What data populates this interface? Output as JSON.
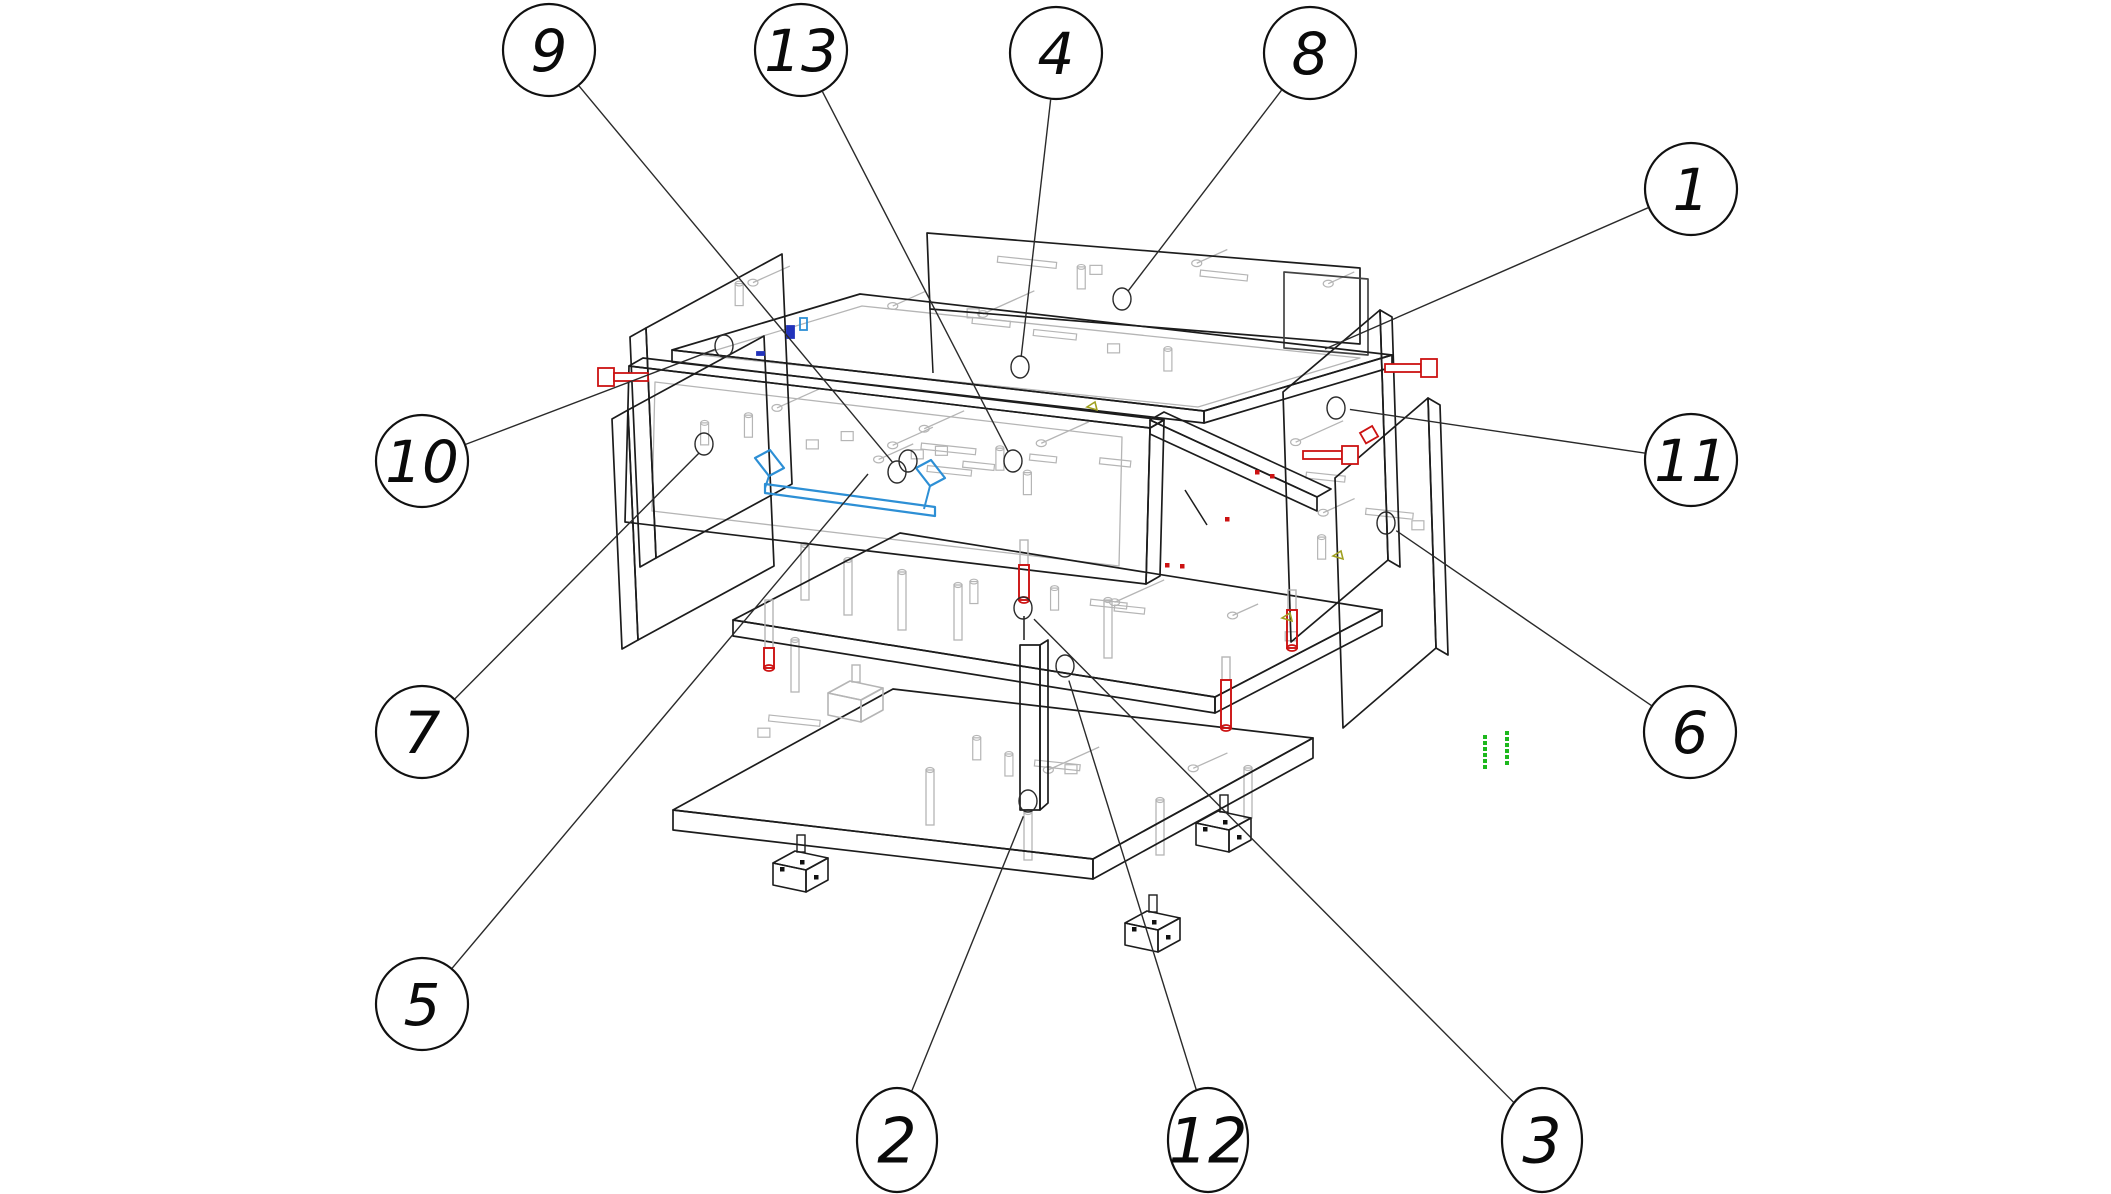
{
  "figure": {
    "title": "exploded-assembly-diagram",
    "description": "Isometric exploded wireframe drawing of a cabinet/drawer unit with numbered part callouts",
    "width": 2111,
    "height": 1194,
    "background": "#ffffff"
  },
  "colors": {
    "outline": "#1c1c1c",
    "detail": "#b5b5b5",
    "leader": "#2a2a2a",
    "red": "#cc1212",
    "blue": "#2d8fd5",
    "navy": "#2233bb",
    "green": "#1db81d",
    "olive": "#a0a020",
    "balloon_stroke": "#111111",
    "balloon_fill": "#ffffff"
  },
  "balloons": [
    {
      "label": "9",
      "x": 549,
      "y": 50,
      "shape": "circle",
      "r": 46,
      "rx": 46,
      "ry": 46,
      "target": [
        899,
        470
      ],
      "marker": true
    },
    {
      "label": "13",
      "x": 801,
      "y": 50,
      "shape": "circle",
      "r": 46,
      "rx": 46,
      "ry": 46,
      "target": [
        1013,
        461
      ],
      "marker": true
    },
    {
      "label": "4",
      "x": 1056,
      "y": 53,
      "shape": "circle",
      "r": 46,
      "rx": 46,
      "ry": 46,
      "target": [
        1020,
        367
      ],
      "marker": true
    },
    {
      "label": "8",
      "x": 1310,
      "y": 53,
      "shape": "circle",
      "r": 46,
      "rx": 46,
      "ry": 46,
      "target": [
        1122,
        299
      ],
      "marker": true
    },
    {
      "label": "1",
      "x": 1691,
      "y": 189,
      "shape": "circle",
      "r": 46,
      "rx": 46,
      "ry": 46,
      "target": [
        1325,
        349
      ],
      "marker": false
    },
    {
      "label": "10",
      "x": 422,
      "y": 461,
      "shape": "circle",
      "r": 46,
      "rx": 46,
      "ry": 46,
      "target": [
        724,
        346
      ],
      "marker": true
    },
    {
      "label": "11",
      "x": 1691,
      "y": 460,
      "shape": "circle",
      "r": 46,
      "rx": 46,
      "ry": 46,
      "target": [
        1340,
        408
      ],
      "marker": true
    },
    {
      "label": "7",
      "x": 422,
      "y": 732,
      "shape": "circle",
      "r": 46,
      "rx": 46,
      "ry": 46,
      "target": [
        706,
        446
      ],
      "marker": true
    },
    {
      "label": "6",
      "x": 1690,
      "y": 732,
      "shape": "circle",
      "r": 46,
      "rx": 46,
      "ry": 46,
      "target": [
        1388,
        525
      ],
      "marker": true
    },
    {
      "label": "5",
      "x": 422,
      "y": 1004,
      "shape": "circle",
      "r": 46,
      "rx": 46,
      "ry": 46,
      "target": [
        868,
        474
      ],
      "marker": false
    },
    {
      "label": "2",
      "x": 897,
      "y": 1140,
      "shape": "oval",
      "r": 48,
      "rx": 40,
      "ry": 52,
      "target": [
        1027,
        807
      ],
      "marker": true
    },
    {
      "label": "12",
      "x": 1208,
      "y": 1140,
      "shape": "oval",
      "r": 48,
      "rx": 40,
      "ry": 52,
      "target": [
        1066,
        671
      ],
      "marker": true
    },
    {
      "label": "3",
      "x": 1542,
      "y": 1140,
      "shape": "oval",
      "r": 48,
      "rx": 40,
      "ry": 52,
      "target": [
        1027,
        612
      ],
      "marker": true
    }
  ],
  "markers": [
    {
      "name": "hole-drawer-a",
      "x": 908,
      "y": 461
    },
    {
      "name": "hole-drawer-b",
      "x": 897,
      "y": 472
    },
    {
      "name": "hole-drawer-c",
      "x": 1013,
      "y": 461
    },
    {
      "name": "hole-lid",
      "x": 1020,
      "y": 367
    },
    {
      "name": "hole-back",
      "x": 1122,
      "y": 299
    },
    {
      "name": "hole-left-top",
      "x": 724,
      "y": 346
    },
    {
      "name": "hole-left-bottom",
      "x": 704,
      "y": 444
    },
    {
      "name": "hole-right-a",
      "x": 1336,
      "y": 408
    },
    {
      "name": "hole-right-b",
      "x": 1386,
      "y": 523
    },
    {
      "name": "hole-divider",
      "x": 1023,
      "y": 608
    },
    {
      "name": "hole-shelf",
      "x": 1065,
      "y": 666
    },
    {
      "name": "hole-base",
      "x": 1028,
      "y": 801
    }
  ],
  "drawing": {
    "panels": [
      {
        "name": "back-panel",
        "pts": [
          [
            927,
            233
          ],
          [
            1360,
            268
          ],
          [
            1360,
            344
          ],
          [
            930,
            309
          ]
        ]
      },
      {
        "name": "back-panel-echo",
        "pts": [
          [
            1284,
            272
          ],
          [
            1368,
            279
          ],
          [
            1368,
            355
          ],
          [
            1284,
            348
          ]
        ]
      },
      {
        "name": "top-panel",
        "pts": [
          [
            672,
            350
          ],
          [
            860,
            294
          ],
          [
            1392,
            355
          ],
          [
            1204,
            411
          ]
        ]
      },
      {
        "name": "top-panel-front",
        "pts": [
          [
            672,
            350
          ],
          [
            672,
            362
          ],
          [
            1204,
            423
          ],
          [
            1204,
            411
          ]
        ]
      },
      {
        "name": "top-panel-tip",
        "pts": [
          [
            1204,
            411
          ],
          [
            1204,
            423
          ],
          [
            1392,
            367
          ],
          [
            1392,
            355
          ]
        ]
      },
      {
        "name": "left-panel-outer",
        "pts": [
          [
            646,
            328
          ],
          [
            782,
            254
          ],
          [
            792,
            484
          ],
          [
            656,
            558
          ]
        ]
      },
      {
        "name": "left-panel-outer-edge",
        "pts": [
          [
            630,
            337
          ],
          [
            646,
            328
          ],
          [
            656,
            558
          ],
          [
            640,
            567
          ]
        ]
      },
      {
        "name": "left-panel-inner",
        "pts": [
          [
            628,
            410
          ],
          [
            764,
            336
          ],
          [
            774,
            566
          ],
          [
            638,
            640
          ]
        ]
      },
      {
        "name": "left-panel-inner-edge",
        "pts": [
          [
            612,
            419
          ],
          [
            628,
            410
          ],
          [
            638,
            640
          ],
          [
            622,
            649
          ]
        ]
      },
      {
        "name": "drawer-front-top",
        "pts": [
          [
            629,
            366
          ],
          [
            643,
            358
          ],
          [
            1164,
            420
          ],
          [
            1150,
            428
          ]
        ]
      },
      {
        "name": "drawer-front",
        "pts": [
          [
            629,
            366
          ],
          [
            1150,
            428
          ],
          [
            1146,
            584
          ],
          [
            625,
            522
          ]
        ]
      },
      {
        "name": "drawer-front-side",
        "pts": [
          [
            1150,
            428
          ],
          [
            1164,
            420
          ],
          [
            1160,
            576
          ],
          [
            1146,
            584
          ]
        ]
      },
      {
        "name": "shelf-top",
        "pts": [
          [
            733,
            620
          ],
          [
            900,
            533
          ],
          [
            1382,
            610
          ],
          [
            1215,
            697
          ]
        ]
      },
      {
        "name": "shelf-front",
        "pts": [
          [
            733,
            620
          ],
          [
            1215,
            697
          ],
          [
            1215,
            713
          ],
          [
            733,
            636
          ]
        ]
      },
      {
        "name": "shelf-side",
        "pts": [
          [
            1215,
            697
          ],
          [
            1382,
            610
          ],
          [
            1382,
            626
          ],
          [
            1215,
            713
          ]
        ]
      },
      {
        "name": "divider-front",
        "pts": [
          [
            1020,
            645
          ],
          [
            1040,
            645
          ],
          [
            1040,
            810
          ],
          [
            1020,
            810
          ]
        ]
      },
      {
        "name": "divider-side",
        "pts": [
          [
            1040,
            645
          ],
          [
            1048,
            640
          ],
          [
            1048,
            803
          ],
          [
            1040,
            810
          ]
        ]
      },
      {
        "name": "base-top",
        "pts": [
          [
            673,
            810
          ],
          [
            893,
            689
          ],
          [
            1313,
            738
          ],
          [
            1093,
            859
          ]
        ]
      },
      {
        "name": "base-front",
        "pts": [
          [
            673,
            810
          ],
          [
            1093,
            859
          ],
          [
            1093,
            879
          ],
          [
            673,
            830
          ]
        ]
      },
      {
        "name": "base-side",
        "pts": [
          [
            1093,
            859
          ],
          [
            1313,
            738
          ],
          [
            1313,
            758
          ],
          [
            1093,
            879
          ]
        ]
      },
      {
        "name": "right-panel-a",
        "pts": [
          [
            1283,
            392
          ],
          [
            1380,
            310
          ],
          [
            1388,
            560
          ],
          [
            1291,
            642
          ]
        ]
      },
      {
        "name": "right-panel-a-edge",
        "pts": [
          [
            1380,
            310
          ],
          [
            1392,
            317
          ],
          [
            1400,
            567
          ],
          [
            1388,
            560
          ]
        ]
      },
      {
        "name": "right-panel-b",
        "pts": [
          [
            1335,
            478
          ],
          [
            1428,
            398
          ],
          [
            1436,
            648
          ],
          [
            1343,
            728
          ]
        ]
      },
      {
        "name": "right-panel-b-edge",
        "pts": [
          [
            1428,
            398
          ],
          [
            1440,
            405
          ],
          [
            1448,
            655
          ],
          [
            1436,
            648
          ]
        ]
      },
      {
        "name": "side-rail",
        "pts": [
          [
            1150,
            420
          ],
          [
            1164,
            412
          ],
          [
            1331,
            489
          ],
          [
            1317,
            497
          ]
        ]
      },
      {
        "name": "side-rail-front",
        "pts": [
          [
            1150,
            420
          ],
          [
            1317,
            497
          ],
          [
            1317,
            511
          ],
          [
            1150,
            434
          ]
        ]
      }
    ],
    "insets": [
      {
        "name": "top-panel-inset",
        "pts": [
          [
            700,
            355
          ],
          [
            862,
            306
          ],
          [
            1360,
            358
          ],
          [
            1198,
            407
          ]
        ]
      },
      {
        "name": "drawer-front-inset",
        "pts": [
          [
            655,
            382
          ],
          [
            1122,
            437
          ],
          [
            1119,
            566
          ],
          [
            652,
            511
          ]
        ]
      }
    ],
    "extra_lines": [
      [
        [
          930,
          309
        ],
        [
          933,
          373
        ]
      ],
      [
        [
          1185,
          490
        ],
        [
          1207,
          525
        ]
      ],
      [
        [
          1024,
          640
        ],
        [
          1024,
          616
        ]
      ]
    ],
    "feet": [
      {
        "x": 773,
        "y": 855,
        "tone": "black"
      },
      {
        "x": 1125,
        "y": 915,
        "tone": "black"
      },
      {
        "x": 1196,
        "y": 815,
        "tone": "black"
      },
      {
        "x": 828,
        "y": 685,
        "tone": "grey"
      }
    ],
    "grey_pegs": [
      {
        "x": 805,
        "top": 545,
        "len": 55
      },
      {
        "x": 848,
        "top": 560,
        "len": 55
      },
      {
        "x": 902,
        "top": 572,
        "len": 58
      },
      {
        "x": 958,
        "top": 585,
        "len": 55
      },
      {
        "x": 1108,
        "top": 600,
        "len": 58
      },
      {
        "x": 795,
        "top": 640,
        "len": 52
      },
      {
        "x": 930,
        "top": 770,
        "len": 55
      },
      {
        "x": 1160,
        "top": 800,
        "len": 55
      },
      {
        "x": 1248,
        "top": 768,
        "len": 50
      },
      {
        "x": 1028,
        "top": 812,
        "len": 48
      }
    ],
    "scatter_regions": [
      {
        "name": "drawer",
        "x0": 665,
        "x1": 1110,
        "y0": 392,
        "y1": 500,
        "slope": 0.117,
        "count": 18
      },
      {
        "name": "lid",
        "x0": 705,
        "x1": 1330,
        "y0": 300,
        "y1": 340,
        "slope": 0.112,
        "count": 9
      },
      {
        "name": "shelf",
        "x0": 765,
        "x1": 1320,
        "y0": 548,
        "y1": 640,
        "slope": 0.14,
        "count": 7
      },
      {
        "name": "base",
        "x0": 700,
        "x1": 1260,
        "y0": 705,
        "y1": 800,
        "slope": 0.11,
        "count": 8
      },
      {
        "name": "back",
        "x0": 945,
        "x1": 1330,
        "y0": 242,
        "y1": 290,
        "slope": 0.08,
        "count": 6
      },
      {
        "name": "right",
        "x0": 1295,
        "x1": 1420,
        "y0": 335,
        "y1": 610,
        "slope": 0.0,
        "count": 6
      }
    ]
  },
  "fasteners": {
    "red_bolts_horizontal": [
      {
        "name": "bolt-left",
        "x": 598,
        "y": 377,
        "len": 50,
        "head": "left"
      },
      {
        "name": "bolt-right-top",
        "x": 1385,
        "y": 368,
        "len": 52,
        "head": "right"
      },
      {
        "name": "bolt-right-mid",
        "x": 1303,
        "y": 455,
        "len": 55,
        "head": "right"
      }
    ],
    "red_pins_vertical": [
      {
        "name": "pin-shelf-left",
        "x": 769,
        "top": 600,
        "grey": 48,
        "red": 20
      },
      {
        "name": "pin-shelf-right",
        "x": 1226,
        "top": 657,
        "grey": 23,
        "red": 48
      },
      {
        "name": "pin-right-panel",
        "x": 1292,
        "top": 590,
        "grey": 20,
        "red": 38
      },
      {
        "name": "pin-center",
        "x": 1024,
        "top": 540,
        "grey": 25,
        "red": 35
      }
    ],
    "red_clip": {
      "x": 1360,
      "y": 433,
      "w": 14,
      "h": 12
    },
    "red_dots": [
      [
        1255,
        470
      ],
      [
        1270,
        474
      ],
      [
        1225,
        517
      ],
      [
        1165,
        563
      ],
      [
        1180,
        564
      ]
    ],
    "blue_rail": {
      "bar": [
        [
          765,
          484
        ],
        [
          935,
          507
        ],
        [
          935,
          516
        ],
        [
          765,
          493
        ]
      ],
      "end_left": [
        [
          755,
          458
        ],
        [
          770,
          450
        ],
        [
          784,
          468
        ],
        [
          769,
          476
        ]
      ],
      "end_right": [
        [
          916,
          468
        ],
        [
          931,
          460
        ],
        [
          945,
          478
        ],
        [
          930,
          486
        ]
      ],
      "connectors": [
        [
          [
            769,
            476
          ],
          [
            765,
            488
          ]
        ],
        [
          [
            930,
            486
          ],
          [
            924,
            509
          ]
        ]
      ]
    },
    "blue_clips": [
      {
        "name": "clip-navy",
        "x": 787,
        "y": 326,
        "w": 7,
        "h": 12,
        "fill": true
      },
      {
        "name": "clip-light",
        "x": 800,
        "y": 318,
        "w": 7,
        "h": 12,
        "fill": false
      },
      {
        "name": "tick-navy",
        "x": 757,
        "y": 352,
        "w": 7,
        "h": 3,
        "fill": true
      }
    ],
    "green_dot_columns": [
      {
        "x": 1483,
        "y0": 735,
        "step": 6,
        "count": 6
      },
      {
        "x": 1505,
        "y0": 731,
        "step": 6,
        "count": 6
      }
    ],
    "olive_marks": [
      [
        1087,
        407
      ],
      [
        1333,
        556
      ],
      [
        1282,
        618
      ]
    ]
  }
}
